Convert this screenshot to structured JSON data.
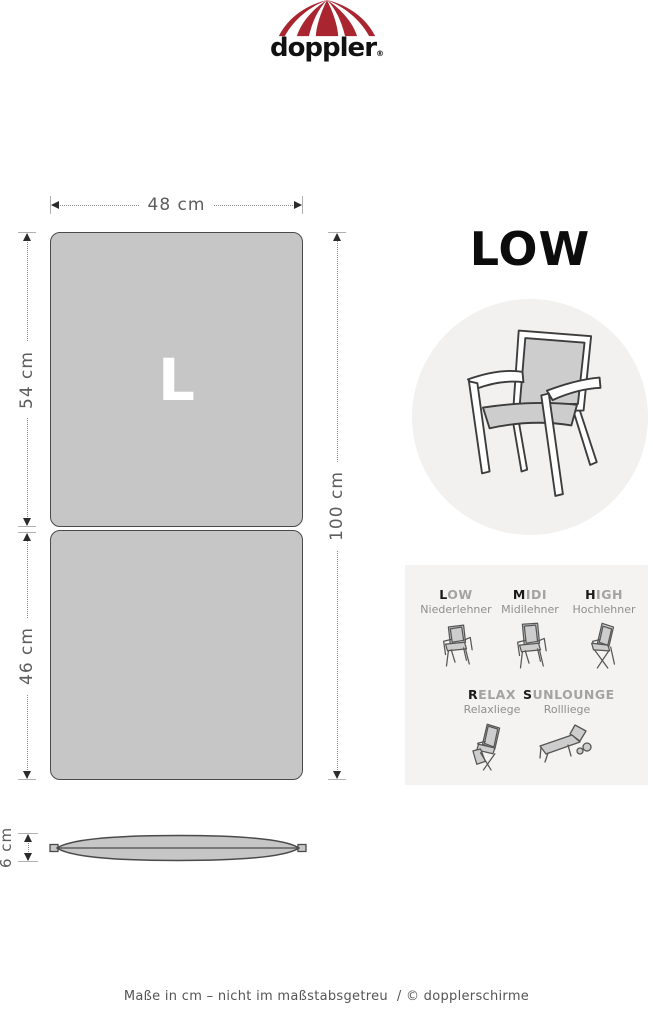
{
  "logo": {
    "brand": "doppler",
    "registered": "®"
  },
  "colors": {
    "brand_red": "#a92631",
    "cushion_fill": "#c6c6c6",
    "cushion_outline": "#4a4a4a",
    "circle_bg": "#f2f1ef",
    "panel_bg": "#f4f3f1",
    "size_letter": "#ffffff",
    "dimension_text": "#5d5d5d",
    "type_title_active": "#1a1a1a",
    "type_title_muted": "#a3a3a3"
  },
  "product": {
    "size_letter": "L",
    "type_heading": "LOW"
  },
  "dimensions": {
    "width": "48 cm",
    "upper_length": "54 cm",
    "lower_length": "46 cm",
    "total_length": "100 cm",
    "thickness": "6 cm"
  },
  "chair_types": [
    {
      "first": "L",
      "rest": "OW",
      "subtitle": "Niederlehner",
      "icon": "armchair-low-icon"
    },
    {
      "first": "M",
      "rest": "IDI",
      "subtitle": "Midilehner",
      "icon": "armchair-midi-icon"
    },
    {
      "first": "H",
      "rest": "IGH",
      "subtitle": "Hochlehner",
      "icon": "armchair-high-icon"
    },
    {
      "first": "R",
      "rest": "ELAX",
      "subtitle": "Relaxliege",
      "icon": "recliner-icon"
    },
    {
      "first": "S",
      "rest": "UNLOUNGE",
      "subtitle": "Rollliege",
      "icon": "sunlounger-icon"
    }
  ],
  "illustrations": {
    "main": "low-back-armchair-icon",
    "umbrella": "umbrella-icon"
  },
  "footer": {
    "note": "Maße in cm – nicht im maßstabsgetreu",
    "separator": "/",
    "copyright": "© dopplerschirme"
  }
}
